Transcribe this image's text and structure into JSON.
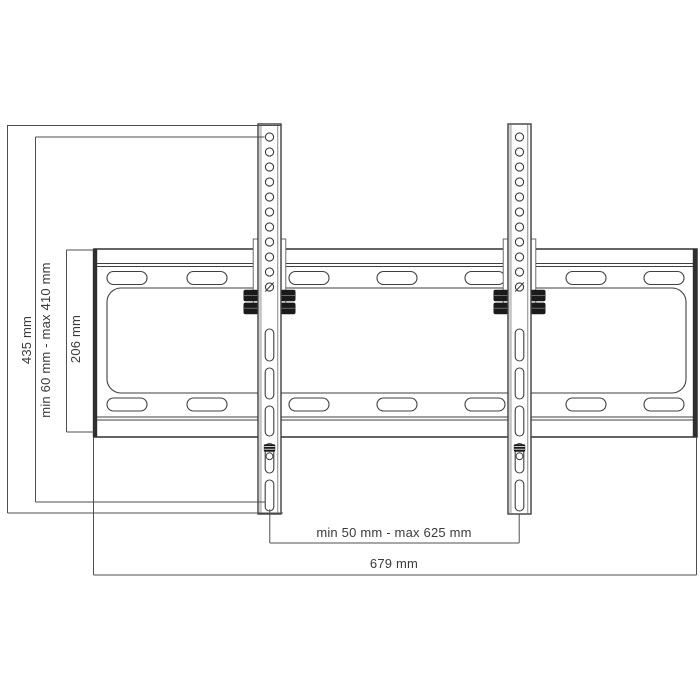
{
  "drawing": {
    "title": "TV wall mount bracket dimension drawing",
    "labels": {
      "rail_height": "435 mm",
      "vertical_adjust_range": "min 60 mm - max 410 mm",
      "plate_height": "206 mm",
      "rail_spacing_range": "min 50 mm - max 625 mm",
      "plate_width": "679 mm"
    },
    "colors": {
      "background": "#ffffff",
      "line": "#3f3f3f",
      "dimension_line": "#4f4f4f",
      "text": "#3a3a3a",
      "bolt_fill": "#1a1a1a",
      "plate_edge_fill": "#2f2f2f"
    }
  }
}
